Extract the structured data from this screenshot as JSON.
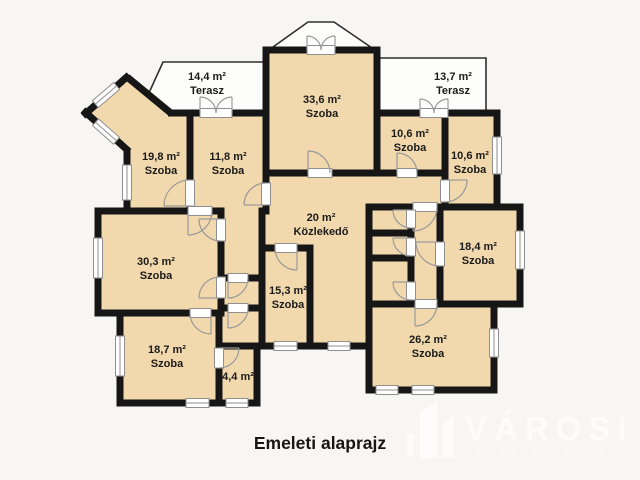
{
  "title": "Emeleti alaprajz",
  "watermark": {
    "brand": "VÁROSI",
    "tagline": "INGATLANIRODA",
    "icon": "building-logo-icon"
  },
  "colors": {
    "background": "#f7f6f2",
    "floor": "#f2d9ad",
    "wall": "#161616",
    "terrace_fill": "#fdfdfb",
    "symbol_gray": "#8f8f8f",
    "label_text": "#1b1b1b",
    "watermark_text": "#fdfcfa"
  },
  "rooms": [
    {
      "id": "terasz-14-4",
      "area": "14,4 m²",
      "name": "Terasz"
    },
    {
      "id": "szoba-33-6",
      "area": "33,6 m²",
      "name": "Szoba"
    },
    {
      "id": "terasz-13-7",
      "area": "13,7 m²",
      "name": "Terasz"
    },
    {
      "id": "szoba-19-8",
      "area": "19,8 m²",
      "name": "Szoba"
    },
    {
      "id": "szoba-11-8",
      "area": "11,8 m²",
      "name": "Szoba"
    },
    {
      "id": "szoba-10-6-bal",
      "area": "10,6 m²",
      "name": "Szoba"
    },
    {
      "id": "szoba-10-6-jobb",
      "area": "10,6 m²",
      "name": "Szoba"
    },
    {
      "id": "kozlekedo-20",
      "area": "20 m²",
      "name": "Közlekedő"
    },
    {
      "id": "szoba-30-3",
      "area": "30,3 m²",
      "name": "Szoba"
    },
    {
      "id": "szoba-18-4",
      "area": "18,4 m²",
      "name": "Szoba"
    },
    {
      "id": "szoba-15-3",
      "area": "15,3 m²",
      "name": "Szoba"
    },
    {
      "id": "szoba-18-7",
      "area": "18,7 m²",
      "name": "Szoba"
    },
    {
      "id": "helyiseg-4-4",
      "area": "4,4 m²",
      "name": ""
    },
    {
      "id": "szoba-26-2",
      "area": "26,2 m²",
      "name": "Szoba"
    }
  ]
}
